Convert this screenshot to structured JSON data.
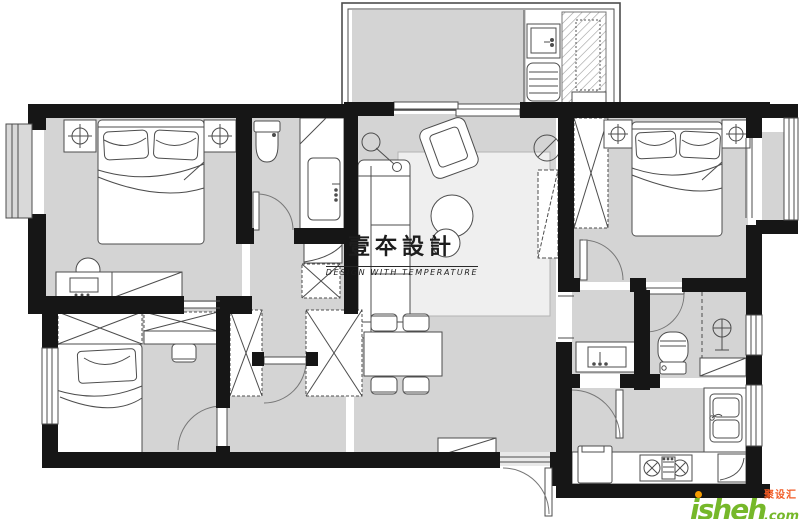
{
  "watermark": {
    "title": "壹夲設計",
    "subtitle": "DESIGN WITH TEMPERATURE"
  },
  "logo": {
    "name": "jsheh",
    "suffix": ".com",
    "chinese": "聚设汇"
  },
  "colors": {
    "wall": "#161616",
    "floor": "#d4d4d4",
    "rug": "#efefef",
    "furniture_fill": "#ffffff",
    "furniture_line": "#4d4d4d",
    "watermark_text": "#1d1d1d",
    "logo_green": "#76b82a",
    "logo_orange": "#f59b00",
    "logo_red": "#f15a24"
  }
}
